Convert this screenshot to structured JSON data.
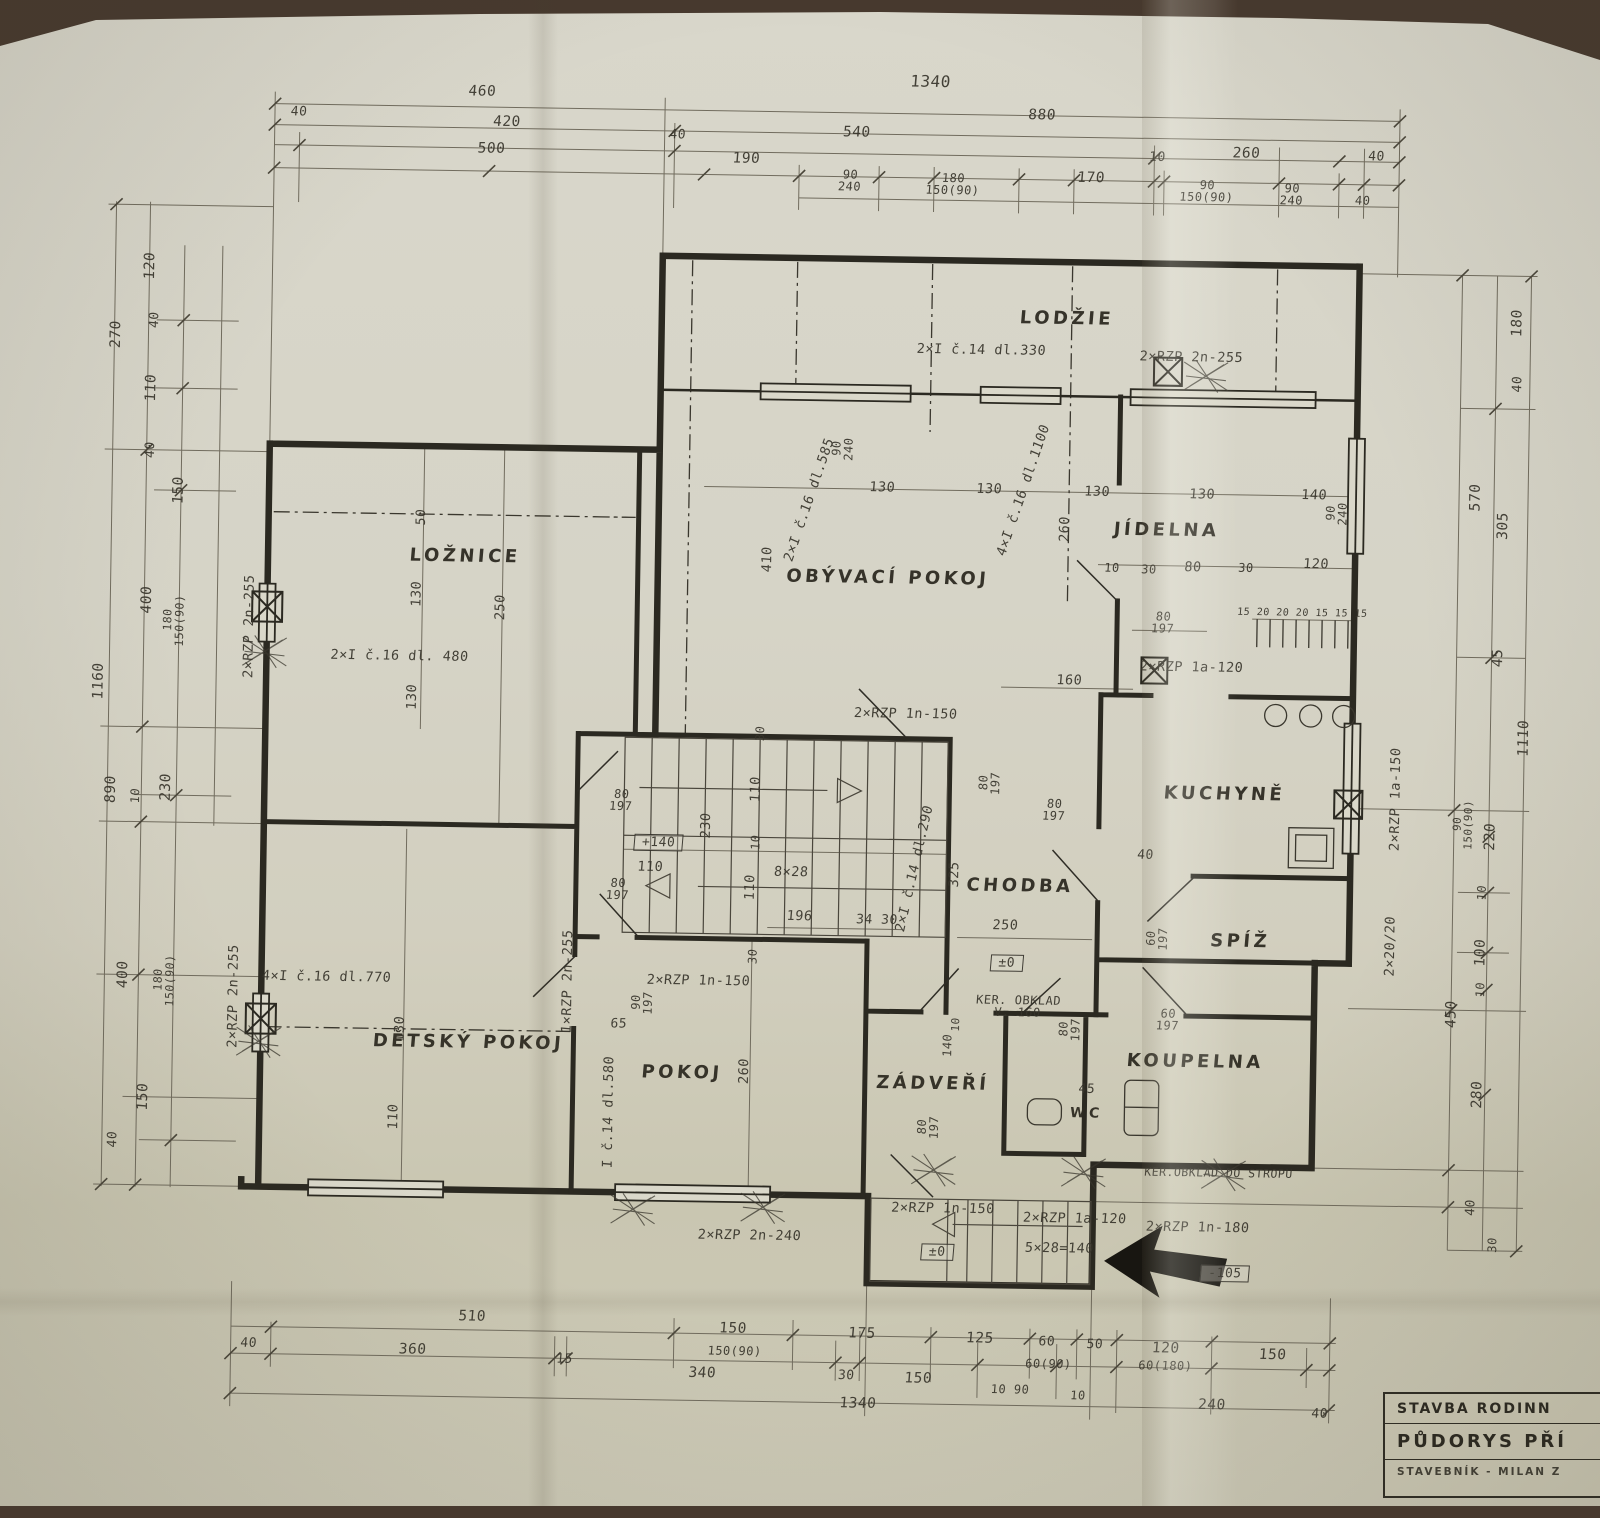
{
  "title_block": {
    "row1": "STAVBA RODINN",
    "row2": "PŮDORYS PŘÍ",
    "row3": "STAVEBNÍK -  MILAN Z"
  },
  "colors": {
    "paper": "#d6d4c7",
    "ink": "#2b2921",
    "pencil": "#716c5e"
  },
  "labels": {
    "rooms": [
      {
        "t": "LODŽIE",
        "x": 1060,
        "y": 315
      },
      {
        "t": "OBÝVACÍ POKOJ",
        "x": 885,
        "y": 577
      },
      {
        "t": "JÍDELNA",
        "x": 1163,
        "y": 525
      },
      {
        "t": "LOŽNICE",
        "x": 462,
        "y": 562
      },
      {
        "t": "KUCHYNĚ",
        "x": 1225,
        "y": 788
      },
      {
        "t": "CHODBA",
        "x": 1022,
        "y": 883
      },
      {
        "t": "SPÍŽ",
        "x": 1243,
        "y": 935
      },
      {
        "t": "DĚTSKÝ POKOJ",
        "x": 473,
        "y": 1048
      },
      {
        "t": "POKOJ",
        "x": 687,
        "y": 1075
      },
      {
        "t": "ZÁDVEŘÍ",
        "x": 938,
        "y": 1082
      },
      {
        "t": "WC",
        "x": 1092,
        "y": 1109,
        "s": 14
      },
      {
        "t": "KOUPELNA",
        "x": 1200,
        "y": 1056
      }
    ],
    "dims_top": [
      {
        "t": "1340",
        "x": 920,
        "y": 80,
        "s": 16
      },
      {
        "t": "460",
        "x": 472,
        "y": 97
      },
      {
        "t": "880",
        "x": 1032,
        "y": 112
      },
      {
        "t": "40",
        "x": 289,
        "y": 120,
        "s": 13
      },
      {
        "t": "420",
        "x": 497,
        "y": 127
      },
      {
        "t": "40",
        "x": 668,
        "y": 137,
        "s": 13
      },
      {
        "t": "540",
        "x": 847,
        "y": 132
      },
      {
        "t": "10",
        "x": 1148,
        "y": 152,
        "s": 13
      },
      {
        "t": "260",
        "x": 1237,
        "y": 147
      },
      {
        "t": "40",
        "x": 1367,
        "y": 148,
        "s": 13
      },
      {
        "t": "500",
        "x": 482,
        "y": 154
      },
      {
        "t": "190",
        "x": 737,
        "y": 160
      },
      {
        "t": "90\n240",
        "x": 841,
        "y": 180,
        "s": 12,
        "c": "frac"
      },
      {
        "t": "180\n150(90)",
        "x": 944,
        "y": 182,
        "s": 12,
        "c": "frac"
      },
      {
        "t": "170",
        "x": 1082,
        "y": 174
      },
      {
        "t": "90\n150(90)",
        "x": 1198,
        "y": 185,
        "s": 12,
        "c": "frac"
      },
      {
        "t": "90\n240",
        "x": 1283,
        "y": 187,
        "s": 12,
        "c": "frac"
      },
      {
        "t": "40",
        "x": 1354,
        "y": 192,
        "s": 12
      }
    ],
    "dims_bottom": [
      {
        "t": "510",
        "x": 481,
        "y": 1322
      },
      {
        "t": "150",
        "x": 742,
        "y": 1330
      },
      {
        "t": "175",
        "x": 871,
        "y": 1333
      },
      {
        "t": "125",
        "x": 989,
        "y": 1336
      },
      {
        "t": "60",
        "x": 1056,
        "y": 1338,
        "s": 13
      },
      {
        "t": "50",
        "x": 1104,
        "y": 1340,
        "s": 13
      },
      {
        "t": "120",
        "x": 1175,
        "y": 1343
      },
      {
        "t": "150",
        "x": 1282,
        "y": 1348
      },
      {
        "t": "40",
        "x": 258,
        "y": 1352,
        "s": 13
      },
      {
        "t": "360",
        "x": 422,
        "y": 1356
      },
      {
        "t": "15",
        "x": 574,
        "y": 1363,
        "s": 13
      },
      {
        "t": "150(90)",
        "x": 744,
        "y": 1352,
        "s": 12
      },
      {
        "t": "340",
        "x": 712,
        "y": 1375
      },
      {
        "t": "30",
        "x": 856,
        "y": 1375,
        "s": 13
      },
      {
        "t": "150",
        "x": 928,
        "y": 1377
      },
      {
        "t": "60(90)",
        "x": 1058,
        "y": 1360,
        "s": 12
      },
      {
        "t": "10  90",
        "x": 1020,
        "y": 1386,
        "s": 12
      },
      {
        "t": "10",
        "x": 1088,
        "y": 1391,
        "s": 12
      },
      {
        "t": "60(180)",
        "x": 1175,
        "y": 1360,
        "s": 12
      },
      {
        "t": "240",
        "x": 1222,
        "y": 1399
      },
      {
        "t": "1340",
        "x": 868,
        "y": 1403
      },
      {
        "t": "40",
        "x": 1330,
        "y": 1406,
        "s": 13
      }
    ],
    "dims_left": [
      {
        "t": "270",
        "x": 110,
        "y": 345,
        "r": -90
      },
      {
        "t": "120",
        "x": 143,
        "y": 276,
        "r": -90
      },
      {
        "t": "40",
        "x": 148,
        "y": 330,
        "r": -90,
        "s": 13
      },
      {
        "t": "110",
        "x": 146,
        "y": 398,
        "r": -90
      },
      {
        "t": "40",
        "x": 146,
        "y": 460,
        "r": -90,
        "s": 13
      },
      {
        "t": "150",
        "x": 175,
        "y": 500,
        "r": -90
      },
      {
        "t": "400",
        "x": 145,
        "y": 610,
        "r": -90
      },
      {
        "t": "180\n150(90)",
        "x": 172,
        "y": 630,
        "r": -90,
        "s": 11.5,
        "c": "frac"
      },
      {
        "t": "1160",
        "x": 98,
        "y": 692,
        "r": -90
      },
      {
        "t": "890",
        "x": 112,
        "y": 800,
        "r": -90
      },
      {
        "t": "10",
        "x": 136,
        "y": 806,
        "r": -90,
        "s": 12
      },
      {
        "t": "230",
        "x": 167,
        "y": 797,
        "r": -90
      },
      {
        "t": "400",
        "x": 127,
        "y": 985,
        "r": -90
      },
      {
        "t": "180\n150(90)",
        "x": 168,
        "y": 990,
        "r": -90,
        "s": 11.5,
        "c": "frac"
      },
      {
        "t": "150",
        "x": 149,
        "y": 1107,
        "r": -90
      },
      {
        "t": "40",
        "x": 119,
        "y": 1150,
        "r": -90,
        "s": 13
      }
    ],
    "dims_right": [
      {
        "t": "180",
        "x": 1511,
        "y": 312,
        "r": -90
      },
      {
        "t": "40",
        "x": 1512,
        "y": 373,
        "r": -90,
        "s": 13
      },
      {
        "t": "570",
        "x": 1472,
        "y": 487,
        "r": -90
      },
      {
        "t": "305",
        "x": 1500,
        "y": 515,
        "r": -90
      },
      {
        "t": "45",
        "x": 1497,
        "y": 647,
        "r": -90
      },
      {
        "t": "1110",
        "x": 1524,
        "y": 727,
        "r": -90
      },
      {
        "t": "90\n150(90)",
        "x": 1464,
        "y": 814,
        "r": -90,
        "s": 11,
        "c": "frac"
      },
      {
        "t": "220",
        "x": 1492,
        "y": 826,
        "r": -90
      },
      {
        "t": "10",
        "x": 1484,
        "y": 882,
        "r": -90,
        "s": 12
      },
      {
        "t": "100",
        "x": 1484,
        "y": 942,
        "r": -90
      },
      {
        "t": "10",
        "x": 1484,
        "y": 979,
        "r": -90,
        "s": 12
      },
      {
        "t": "450",
        "x": 1456,
        "y": 1004,
        "r": -90
      },
      {
        "t": "280",
        "x": 1483,
        "y": 1084,
        "r": -90
      },
      {
        "t": "40",
        "x": 1478,
        "y": 1197,
        "r": -90,
        "s": 13
      },
      {
        "t": "30",
        "x": 1500,
        "y": 1234,
        "r": -90,
        "s": 12
      }
    ],
    "notes": [
      {
        "t": "2×I č.14 dl.330",
        "x": 975,
        "y": 348
      },
      {
        "t": "2×RZP 2n-255",
        "x": 1185,
        "y": 352
      },
      {
        "t": "90\n240",
        "x": 838,
        "y": 448,
        "r": -90,
        "s": 12,
        "c": "frac"
      },
      {
        "t": "90\n240",
        "x": 1333,
        "y": 505,
        "r": -90,
        "s": 12,
        "c": "frac"
      },
      {
        "t": "2×I č.16 dl.585",
        "x": 806,
        "y": 500,
        "r": -72
      },
      {
        "t": "4×I č.16 dl.1100",
        "x": 1020,
        "y": 487,
        "r": -72
      },
      {
        "t": "410",
        "x": 765,
        "y": 560,
        "r": -90
      },
      {
        "t": "130",
        "x": 878,
        "y": 487
      },
      {
        "t": "130",
        "x": 985,
        "y": 487
      },
      {
        "t": "130",
        "x": 1093,
        "y": 488
      },
      {
        "t": "130",
        "x": 1198,
        "y": 489
      },
      {
        "t": "140",
        "x": 1310,
        "y": 488
      },
      {
        "t": "260",
        "x": 1062,
        "y": 525,
        "r": -90
      },
      {
        "t": "10",
        "x": 1109,
        "y": 563,
        "s": 12
      },
      {
        "t": "30",
        "x": 1146,
        "y": 564,
        "s": 12
      },
      {
        "t": "80",
        "x": 1190,
        "y": 562
      },
      {
        "t": "30",
        "x": 1243,
        "y": 561,
        "s": 12
      },
      {
        "t": "120",
        "x": 1313,
        "y": 557
      },
      {
        "t": "80\n197",
        "x": 1161,
        "y": 617,
        "s": 12,
        "c": "frac"
      },
      {
        "t": "15 20 20 20 15 15 15",
        "x": 1300,
        "y": 606,
        "s": 10
      },
      {
        "t": "2×RZP 1a-120",
        "x": 1190,
        "y": 662
      },
      {
        "t": "160",
        "x": 1068,
        "y": 677
      },
      {
        "t": "2×RZP 1n-150",
        "x": 905,
        "y": 713
      },
      {
        "t": "2×RZP 2n-255",
        "x": 248,
        "y": 635,
        "r": -90
      },
      {
        "t": "2×RZP 2n-255",
        "x": 238,
        "y": 1005,
        "r": -90
      },
      {
        "t": "50",
        "x": 418,
        "y": 523,
        "r": -90,
        "s": 13
      },
      {
        "t": "130",
        "x": 415,
        "y": 600,
        "r": -90
      },
      {
        "t": "130",
        "x": 412,
        "y": 703,
        "r": -90
      },
      {
        "t": "250",
        "x": 499,
        "y": 612,
        "r": -90
      },
      {
        "t": "2×I č.16 dl. 480",
        "x": 398,
        "y": 663
      },
      {
        "t": "4×I č.16 dl.770",
        "x": 330,
        "y": 985
      },
      {
        "t": "130",
        "x": 405,
        "y": 1035,
        "r": -90
      },
      {
        "t": "110",
        "x": 400,
        "y": 1123,
        "r": -90
      },
      {
        "t": "1×RZP 2n-255",
        "x": 572,
        "y": 985,
        "r": -90
      },
      {
        "t": "I č.14 dl.580",
        "x": 615,
        "y": 1115,
        "r": -90
      },
      {
        "t": "65",
        "x": 623,
        "y": 1027,
        "s": 13
      },
      {
        "t": "90\n197",
        "x": 646,
        "y": 1005,
        "r": -90,
        "s": 12,
        "c": "frac"
      },
      {
        "t": "260",
        "x": 750,
        "y": 1072,
        "r": -90
      },
      {
        "t": "2×RZP 1n-150",
        "x": 702,
        "y": 983
      },
      {
        "t": "30",
        "x": 760,
        "y": 734,
        "r": -90,
        "s": 12
      },
      {
        "t": "80\n197",
        "x": 622,
        "y": 803,
        "s": 12,
        "c": "frac"
      },
      {
        "t": "+140",
        "x": 660,
        "y": 845,
        "c": "box",
        "s": 13
      },
      {
        "t": "230",
        "x": 708,
        "y": 827,
        "r": -90
      },
      {
        "t": "110",
        "x": 757,
        "y": 790,
        "r": -90
      },
      {
        "t": "10",
        "x": 757,
        "y": 843,
        "r": -90,
        "s": 12
      },
      {
        "t": "110",
        "x": 652,
        "y": 870
      },
      {
        "t": "80\n197",
        "x": 620,
        "y": 892,
        "s": 12,
        "c": "frac"
      },
      {
        "t": "8×28",
        "x": 793,
        "y": 873
      },
      {
        "t": "110",
        "x": 753,
        "y": 888,
        "r": -90
      },
      {
        "t": "196",
        "x": 802,
        "y": 917
      },
      {
        "t": "34",
        "x": 867,
        "y": 919,
        "s": 13
      },
      {
        "t": "30",
        "x": 892,
        "y": 919,
        "s": 13
      },
      {
        "t": "2×I č.14 dl.290",
        "x": 917,
        "y": 867,
        "r": -78
      },
      {
        "t": "325",
        "x": 957,
        "y": 872,
        "r": -90
      },
      {
        "t": "30",
        "x": 756,
        "y": 957,
        "r": -90,
        "s": 12
      },
      {
        "t": "80\n197",
        "x": 990,
        "y": 780,
        "r": -90,
        "s": 12,
        "c": "frac"
      },
      {
        "t": "80\n197",
        "x": 1055,
        "y": 806,
        "s": 12,
        "c": "frac"
      },
      {
        "t": "40",
        "x": 1147,
        "y": 850,
        "s": 13
      },
      {
        "t": "250",
        "x": 1008,
        "y": 923
      },
      {
        "t": "±0",
        "x": 1010,
        "y": 960,
        "c": "box",
        "s": 13
      },
      {
        "t": "60\n197",
        "x": 1160,
        "y": 933,
        "r": -90,
        "s": 12,
        "c": "frac"
      },
      {
        "t": "KER. OBKLAD\nV. 160",
        "x": 1022,
        "y": 1003,
        "s": 12
      },
      {
        "t": "140",
        "x": 952,
        "y": 1043,
        "r": -90,
        "s": 12
      },
      {
        "t": "10",
        "x": 960,
        "y": 1022,
        "r": -90,
        "s": 11
      },
      {
        "t": "45",
        "x": 1092,
        "y": 1085,
        "s": 13
      },
      {
        "t": "60\n197",
        "x": 1172,
        "y": 1014,
        "s": 12,
        "c": "frac"
      },
      {
        "t": "80\n197",
        "x": 1074,
        "y": 1025,
        "r": -90,
        "s": 12,
        "c": "frac"
      },
      {
        "t": "80\n197",
        "x": 934,
        "y": 1125,
        "r": -90,
        "s": 12,
        "c": "frac"
      },
      {
        "t": "KER.OBKLAD DO STROPU",
        "x": 1225,
        "y": 1167,
        "s": 11.5
      },
      {
        "t": "2×RZP 1n-150",
        "x": 950,
        "y": 1207
      },
      {
        "t": "2×RZP 1a-120",
        "x": 1082,
        "y": 1215
      },
      {
        "t": "2×RZP 1n-180",
        "x": 1205,
        "y": 1222
      },
      {
        "t": "5×28=140",
        "x": 1067,
        "y": 1245
      },
      {
        "t": "±0",
        "x": 945,
        "y": 1250,
        "c": "box",
        "s": 13
      },
      {
        "t": "-105",
        "x": 1233,
        "y": 1267,
        "c": "box",
        "s": 13
      },
      {
        "t": "2×RZP 1a-150",
        "x": 1397,
        "y": 790,
        "r": -90
      },
      {
        "t": "2×20/20",
        "x": 1394,
        "y": 937,
        "r": -90
      },
      {
        "t": "2×RZP 2n-240",
        "x": 757,
        "y": 1237
      }
    ]
  }
}
